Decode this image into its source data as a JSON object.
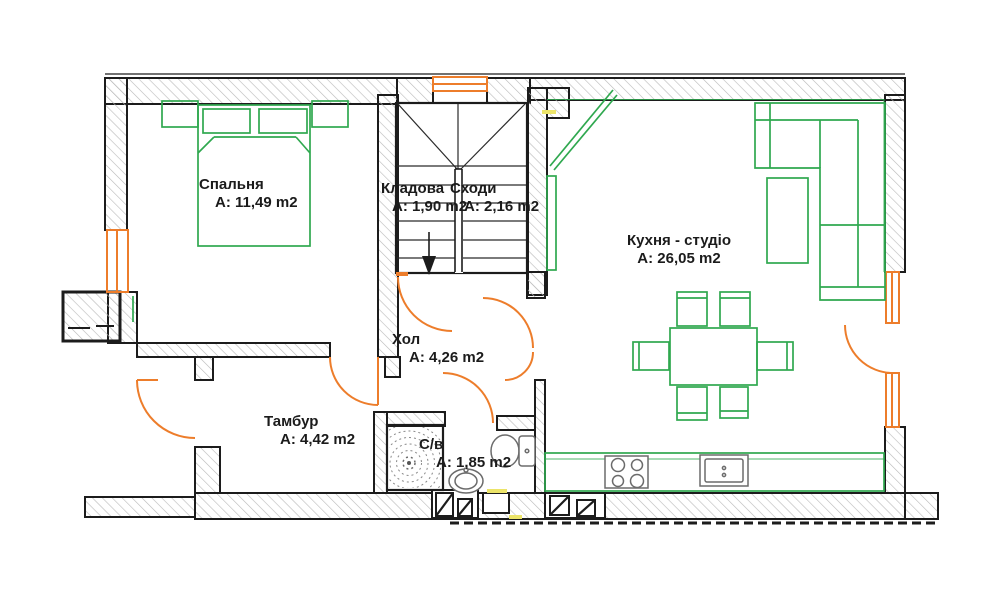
{
  "plan_title": "Apartment floor plan",
  "rooms": {
    "bedroom": {
      "name": "Спальня",
      "area": "A: 11,49 m2"
    },
    "storage": {
      "name": "Кладова",
      "area": "A: 1,90 m2"
    },
    "stairs": {
      "name": "Сходи",
      "area": "A: 2,16 m2"
    },
    "kitchen": {
      "name": "Кухня - студіо",
      "area": "A: 26,05 m2"
    },
    "hall": {
      "name": "Хол",
      "area": "A: 4,26 m2"
    },
    "vestibule": {
      "name": "Тамбур",
      "area": "A: 4,42 m2"
    },
    "bathroom": {
      "name": "С/в",
      "area": "A: 1,85 m2"
    }
  },
  "symbols": {
    "stairs_direction_arrow": "down"
  },
  "colors": {
    "wall": "#1c1c1c",
    "hatch": "#b9b9b9",
    "furniture_green": "#2fa84f",
    "door_window_orange": "#ed7d2b",
    "accent_yellow": "#ece469",
    "fixture_gray": "#6b6b6b"
  }
}
